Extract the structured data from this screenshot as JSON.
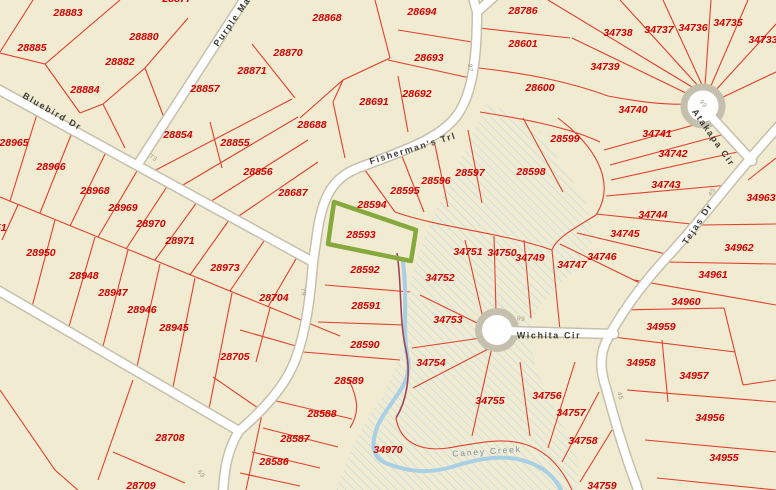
{
  "map_title": "Parcel map with highlighted lot 28593",
  "colors": {
    "background": "#f1ecd1",
    "parcel_line": "#e2402f",
    "parcel_label": "#d40000",
    "road_fill": "#ffffff",
    "road_casing": "#c5bfad",
    "street_label": "#3f3f37",
    "road_number": "#a09a8c",
    "creek": "#a9cfe4",
    "creek_label": "#7f95a6",
    "flood_hatch": "#b9d7e8",
    "highlight": "#86a93d",
    "boundary_line": "#a04458"
  },
  "highlighted_parcel": {
    "id": "28593"
  },
  "parcels": [
    {
      "t": "28877",
      "x": 177,
      "y": -1
    },
    {
      "t": "28883",
      "x": 68,
      "y": 13
    },
    {
      "t": "28885",
      "x": 32,
      "y": 48
    },
    {
      "t": "28880",
      "x": 144,
      "y": 37
    },
    {
      "t": "28882",
      "x": 120,
      "y": 62
    },
    {
      "t": "28884",
      "x": 85,
      "y": 90
    },
    {
      "t": "28868",
      "x": 327,
      "y": 18
    },
    {
      "t": "28870",
      "x": 288,
      "y": 53
    },
    {
      "t": "28871",
      "x": 252,
      "y": 71
    },
    {
      "t": "28857",
      "x": 205,
      "y": 89
    },
    {
      "t": "28854",
      "x": 178,
      "y": 135
    },
    {
      "t": "28855",
      "x": 235,
      "y": 143
    },
    {
      "t": "28856",
      "x": 258,
      "y": 172
    },
    {
      "t": "28687",
      "x": 293,
      "y": 193
    },
    {
      "t": "28688",
      "x": 312,
      "y": 125
    },
    {
      "t": "28691",
      "x": 374,
      "y": 102
    },
    {
      "t": "28692",
      "x": 417,
      "y": 94
    },
    {
      "t": "28693",
      "x": 429,
      "y": 58
    },
    {
      "t": "28694",
      "x": 422,
      "y": 12
    },
    {
      "t": "28786",
      "x": 523,
      "y": 11
    },
    {
      "t": "28601",
      "x": 523,
      "y": 44
    },
    {
      "t": "28600",
      "x": 540,
      "y": 88
    },
    {
      "t": "28599",
      "x": 565,
      "y": 139
    },
    {
      "t": "28598",
      "x": 531,
      "y": 172
    },
    {
      "t": "28597",
      "x": 470,
      "y": 173
    },
    {
      "t": "28596",
      "x": 436,
      "y": 181
    },
    {
      "t": "28595",
      "x": 405,
      "y": 191
    },
    {
      "t": "28594",
      "x": 372,
      "y": 205
    },
    {
      "t": "28593",
      "x": 361,
      "y": 235
    },
    {
      "t": "28592",
      "x": 365,
      "y": 270
    },
    {
      "t": "28591",
      "x": 366,
      "y": 306
    },
    {
      "t": "28590",
      "x": 365,
      "y": 345
    },
    {
      "t": "28589",
      "x": 349,
      "y": 381
    },
    {
      "t": "28588",
      "x": 322,
      "y": 414
    },
    {
      "t": "28587",
      "x": 295,
      "y": 439
    },
    {
      "t": "28586",
      "x": 274,
      "y": 462
    },
    {
      "t": "28965",
      "x": 14,
      "y": 143
    },
    {
      "t": "28966",
      "x": 51,
      "y": 167
    },
    {
      "t": "28968",
      "x": 95,
      "y": 191
    },
    {
      "t": "28969",
      "x": 123,
      "y": 208
    },
    {
      "t": "28970",
      "x": 151,
      "y": 224
    },
    {
      "t": "28971",
      "x": 180,
      "y": 241
    },
    {
      "t": "28973",
      "x": 225,
      "y": 268
    },
    {
      "t": "28951",
      "x": -8,
      "y": 228
    },
    {
      "t": "28950",
      "x": 41,
      "y": 253
    },
    {
      "t": "28948",
      "x": 84,
      "y": 276
    },
    {
      "t": "28947",
      "x": 113,
      "y": 293
    },
    {
      "t": "28946",
      "x": 142,
      "y": 310
    },
    {
      "t": "28945",
      "x": 174,
      "y": 328
    },
    {
      "t": "28704",
      "x": 274,
      "y": 298
    },
    {
      "t": "28705",
      "x": 235,
      "y": 357
    },
    {
      "t": "28708",
      "x": 170,
      "y": 438
    },
    {
      "t": "28709",
      "x": 141,
      "y": 486
    },
    {
      "t": "34738",
      "x": 618,
      "y": 33
    },
    {
      "t": "34737",
      "x": 659,
      "y": 30
    },
    {
      "t": "34736",
      "x": 693,
      "y": 28
    },
    {
      "t": "34735",
      "x": 728,
      "y": 23
    },
    {
      "t": "34733",
      "x": 763,
      "y": 40
    },
    {
      "t": "34739",
      "x": 605,
      "y": 67
    },
    {
      "t": "34740",
      "x": 633,
      "y": 110
    },
    {
      "t": "34741",
      "x": 657,
      "y": 134
    },
    {
      "t": "34742",
      "x": 673,
      "y": 154
    },
    {
      "t": "34743",
      "x": 666,
      "y": 185
    },
    {
      "t": "34744",
      "x": 653,
      "y": 215
    },
    {
      "t": "34745",
      "x": 625,
      "y": 234
    },
    {
      "t": "34746",
      "x": 602,
      "y": 257
    },
    {
      "t": "34747",
      "x": 572,
      "y": 265
    },
    {
      "t": "34749",
      "x": 530,
      "y": 258
    },
    {
      "t": "34750",
      "x": 502,
      "y": 253
    },
    {
      "t": "34751",
      "x": 468,
      "y": 252
    },
    {
      "t": "34752",
      "x": 440,
      "y": 278
    },
    {
      "t": "34753",
      "x": 448,
      "y": 320
    },
    {
      "t": "34754",
      "x": 431,
      "y": 363
    },
    {
      "t": "34755",
      "x": 490,
      "y": 401
    },
    {
      "t": "34756",
      "x": 547,
      "y": 396
    },
    {
      "t": "34757",
      "x": 571,
      "y": 413
    },
    {
      "t": "34758",
      "x": 583,
      "y": 441
    },
    {
      "t": "34759",
      "x": 602,
      "y": 486
    },
    {
      "t": "34970",
      "x": 388,
      "y": 450
    },
    {
      "t": "34955",
      "x": 724,
      "y": 458
    },
    {
      "t": "34956",
      "x": 710,
      "y": 418
    },
    {
      "t": "34957",
      "x": 694,
      "y": 376
    },
    {
      "t": "34958",
      "x": 641,
      "y": 363
    },
    {
      "t": "34959",
      "x": 661,
      "y": 327
    },
    {
      "t": "34960",
      "x": 686,
      "y": 302
    },
    {
      "t": "34961",
      "x": 713,
      "y": 275
    },
    {
      "t": "34962",
      "x": 739,
      "y": 248
    },
    {
      "t": "34963",
      "x": 761,
      "y": 198
    }
  ],
  "streets": [
    {
      "t": "Bluebird Dr",
      "x": 52,
      "y": 112,
      "r": 30
    },
    {
      "t": "Purple Mar",
      "x": 234,
      "y": 20,
      "r": -55
    },
    {
      "t": "Fisherman's Trl",
      "x": 413,
      "y": 149,
      "r": -17
    },
    {
      "t": "Wichita Cir",
      "x": 549,
      "y": 336,
      "r": 0
    },
    {
      "t": "Tejas Dr",
      "x": 698,
      "y": 224,
      "r": -57
    },
    {
      "t": "Atakapa Cir",
      "x": 713,
      "y": 138,
      "r": 55
    }
  ],
  "road_numbers": [
    {
      "t": "73",
      "x": 153,
      "y": 158,
      "r": 30
    },
    {
      "t": "79",
      "x": 303,
      "y": 292,
      "r": 80
    },
    {
      "t": "69",
      "x": 201,
      "y": 474,
      "r": 55
    },
    {
      "t": "97",
      "x": 470,
      "y": 68,
      "r": 85
    },
    {
      "t": "99",
      "x": 521,
      "y": 319,
      "r": 10
    },
    {
      "t": "99",
      "x": 703,
      "y": 104,
      "r": 55
    },
    {
      "t": "45",
      "x": 712,
      "y": 192,
      "r": -57
    },
    {
      "t": "45",
      "x": 620,
      "y": 396,
      "r": 75
    }
  ],
  "creek_label": {
    "t": "Caney Creek",
    "x": 487,
    "y": 452,
    "r": -4
  }
}
